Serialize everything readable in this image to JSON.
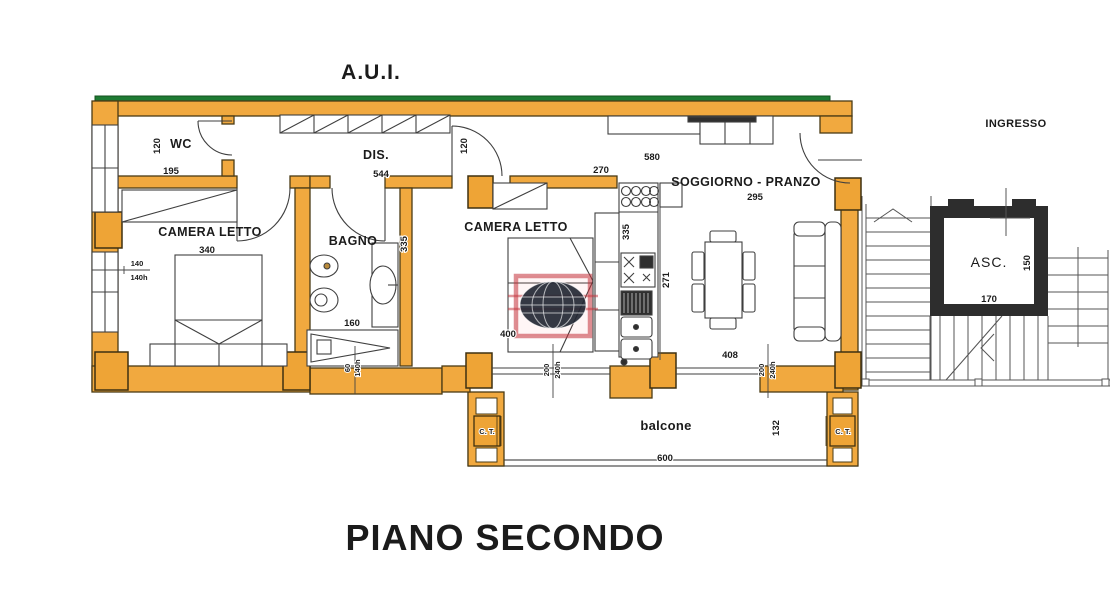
{
  "title": "A.U.I.",
  "floor_title": "PIANO SECONDO",
  "labels": {
    "wc": "WC",
    "dis": "DIS.",
    "camera_letto_1": "CAMERA LETTO",
    "bagno": "BAGNO",
    "camera_letto_2": "CAMERA LETTO",
    "soggiorno_pranzo": "SOGGIORNO - PRANZO",
    "balcone": "balcone",
    "ingresso": "INGRESSO",
    "asc": "ASC.",
    "ct_left": "C. T.",
    "ct_right": "C. T."
  },
  "dims": {
    "wc_depth": "120",
    "wc_width": "195",
    "dis_length": "544",
    "camera1_width": "340",
    "left_window_w": "140",
    "left_window_h": "140h",
    "bagno_depth": "335",
    "shower_length": "160",
    "bagno_window_w": "60",
    "bagno_window_h": "140h",
    "camera2_door_side": "120",
    "camera2_top": "270",
    "camera2_width": "400",
    "kitchen_counter": "335",
    "kitchen_depth": "271",
    "soggiorno_length": "580",
    "soggiorno_width": "295",
    "living_width": "408",
    "french_window_1_w": "200",
    "french_window_1_h": "240h",
    "french_window_2_w": "200",
    "french_window_2_h": "240h",
    "balcone_length": "600",
    "balcone_depth": "132",
    "asc_width": "170",
    "asc_depth": "150"
  },
  "colors": {
    "wall": "#f1a93f",
    "wall_block": "#eea436",
    "green_roof": "#1e7b33",
    "elevator_wall": "#2d2d2d",
    "title_red": "#e8391c",
    "watermark_red": "#c22f38"
  },
  "watermark": {
    "icon": "globe-logo"
  }
}
